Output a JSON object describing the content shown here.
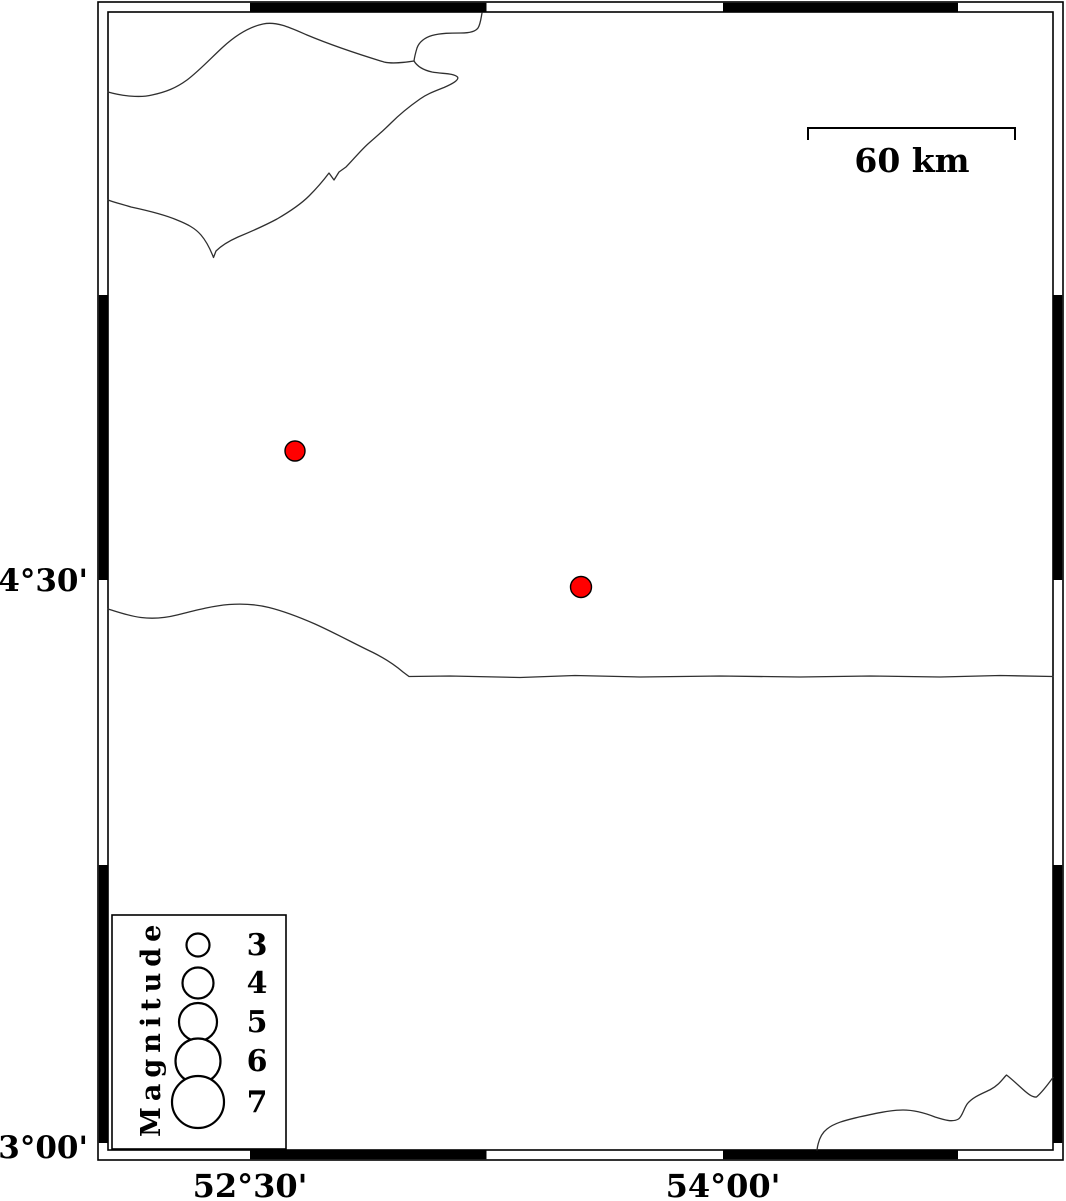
{
  "map": {
    "kind": "seismicity-epicenter-map",
    "background_color": "#ffffff",
    "frame_color": "#000000",
    "coastline_color": "#2f2f2f"
  },
  "axis": {
    "lat_labels": [
      {
        "text": "34°30'",
        "y_px": 580
      },
      {
        "text": "33°00'",
        "y_px": 1147
      }
    ],
    "lon_labels": [
      {
        "text": "52°30'",
        "x_px": 250
      },
      {
        "text": "54°00'",
        "x_px": 723
      }
    ]
  },
  "scalebar": {
    "label": "60 km",
    "length_px": 207
  },
  "legend": {
    "title": "Magnitude",
    "entries": [
      {
        "label": "3",
        "magnitude": 3,
        "r_px": 11.5
      },
      {
        "label": "4",
        "magnitude": 4,
        "r_px": 15.5
      },
      {
        "label": "5",
        "magnitude": 5,
        "r_px": 19
      },
      {
        "label": "6",
        "magnitude": 6,
        "r_px": 22.5
      },
      {
        "label": "7",
        "magnitude": 7,
        "r_px": 26
      }
    ]
  },
  "epicenters": {
    "fill": "#ff0000",
    "stroke": "#000000",
    "points": [
      {
        "x_px": 295,
        "y_px": 451,
        "r_px": 10,
        "approx_lon_deg": 52.64,
        "approx_lat_deg": 34.84
      },
      {
        "x_px": 581,
        "y_px": 587,
        "r_px": 10.5,
        "approx_lon_deg": 53.55,
        "approx_lat_deg": 34.48
      }
    ]
  }
}
